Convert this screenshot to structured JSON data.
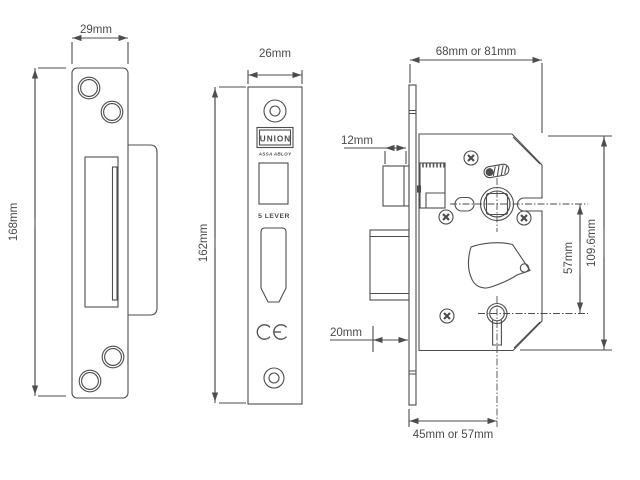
{
  "page": {
    "background": "#ffffff",
    "line_color": "#4d4d4d"
  },
  "views": {
    "strike_plate": {
      "width_label": "29mm",
      "height_label": "168mm"
    },
    "faceplate": {
      "width_label": "26mm",
      "height_label": "162mm",
      "brand": "UNION",
      "brand_sub": "ASSA ABLOY",
      "lever_label": "5 LEVER",
      "ce_mark": "CE"
    },
    "lock_body": {
      "depth_label": "68mm or 81mm",
      "latch_label": "12mm",
      "bolt_label": "20mm",
      "centres_label": "57mm",
      "height_label": "109.6mm",
      "backset_label": "45mm or 57mm"
    }
  }
}
